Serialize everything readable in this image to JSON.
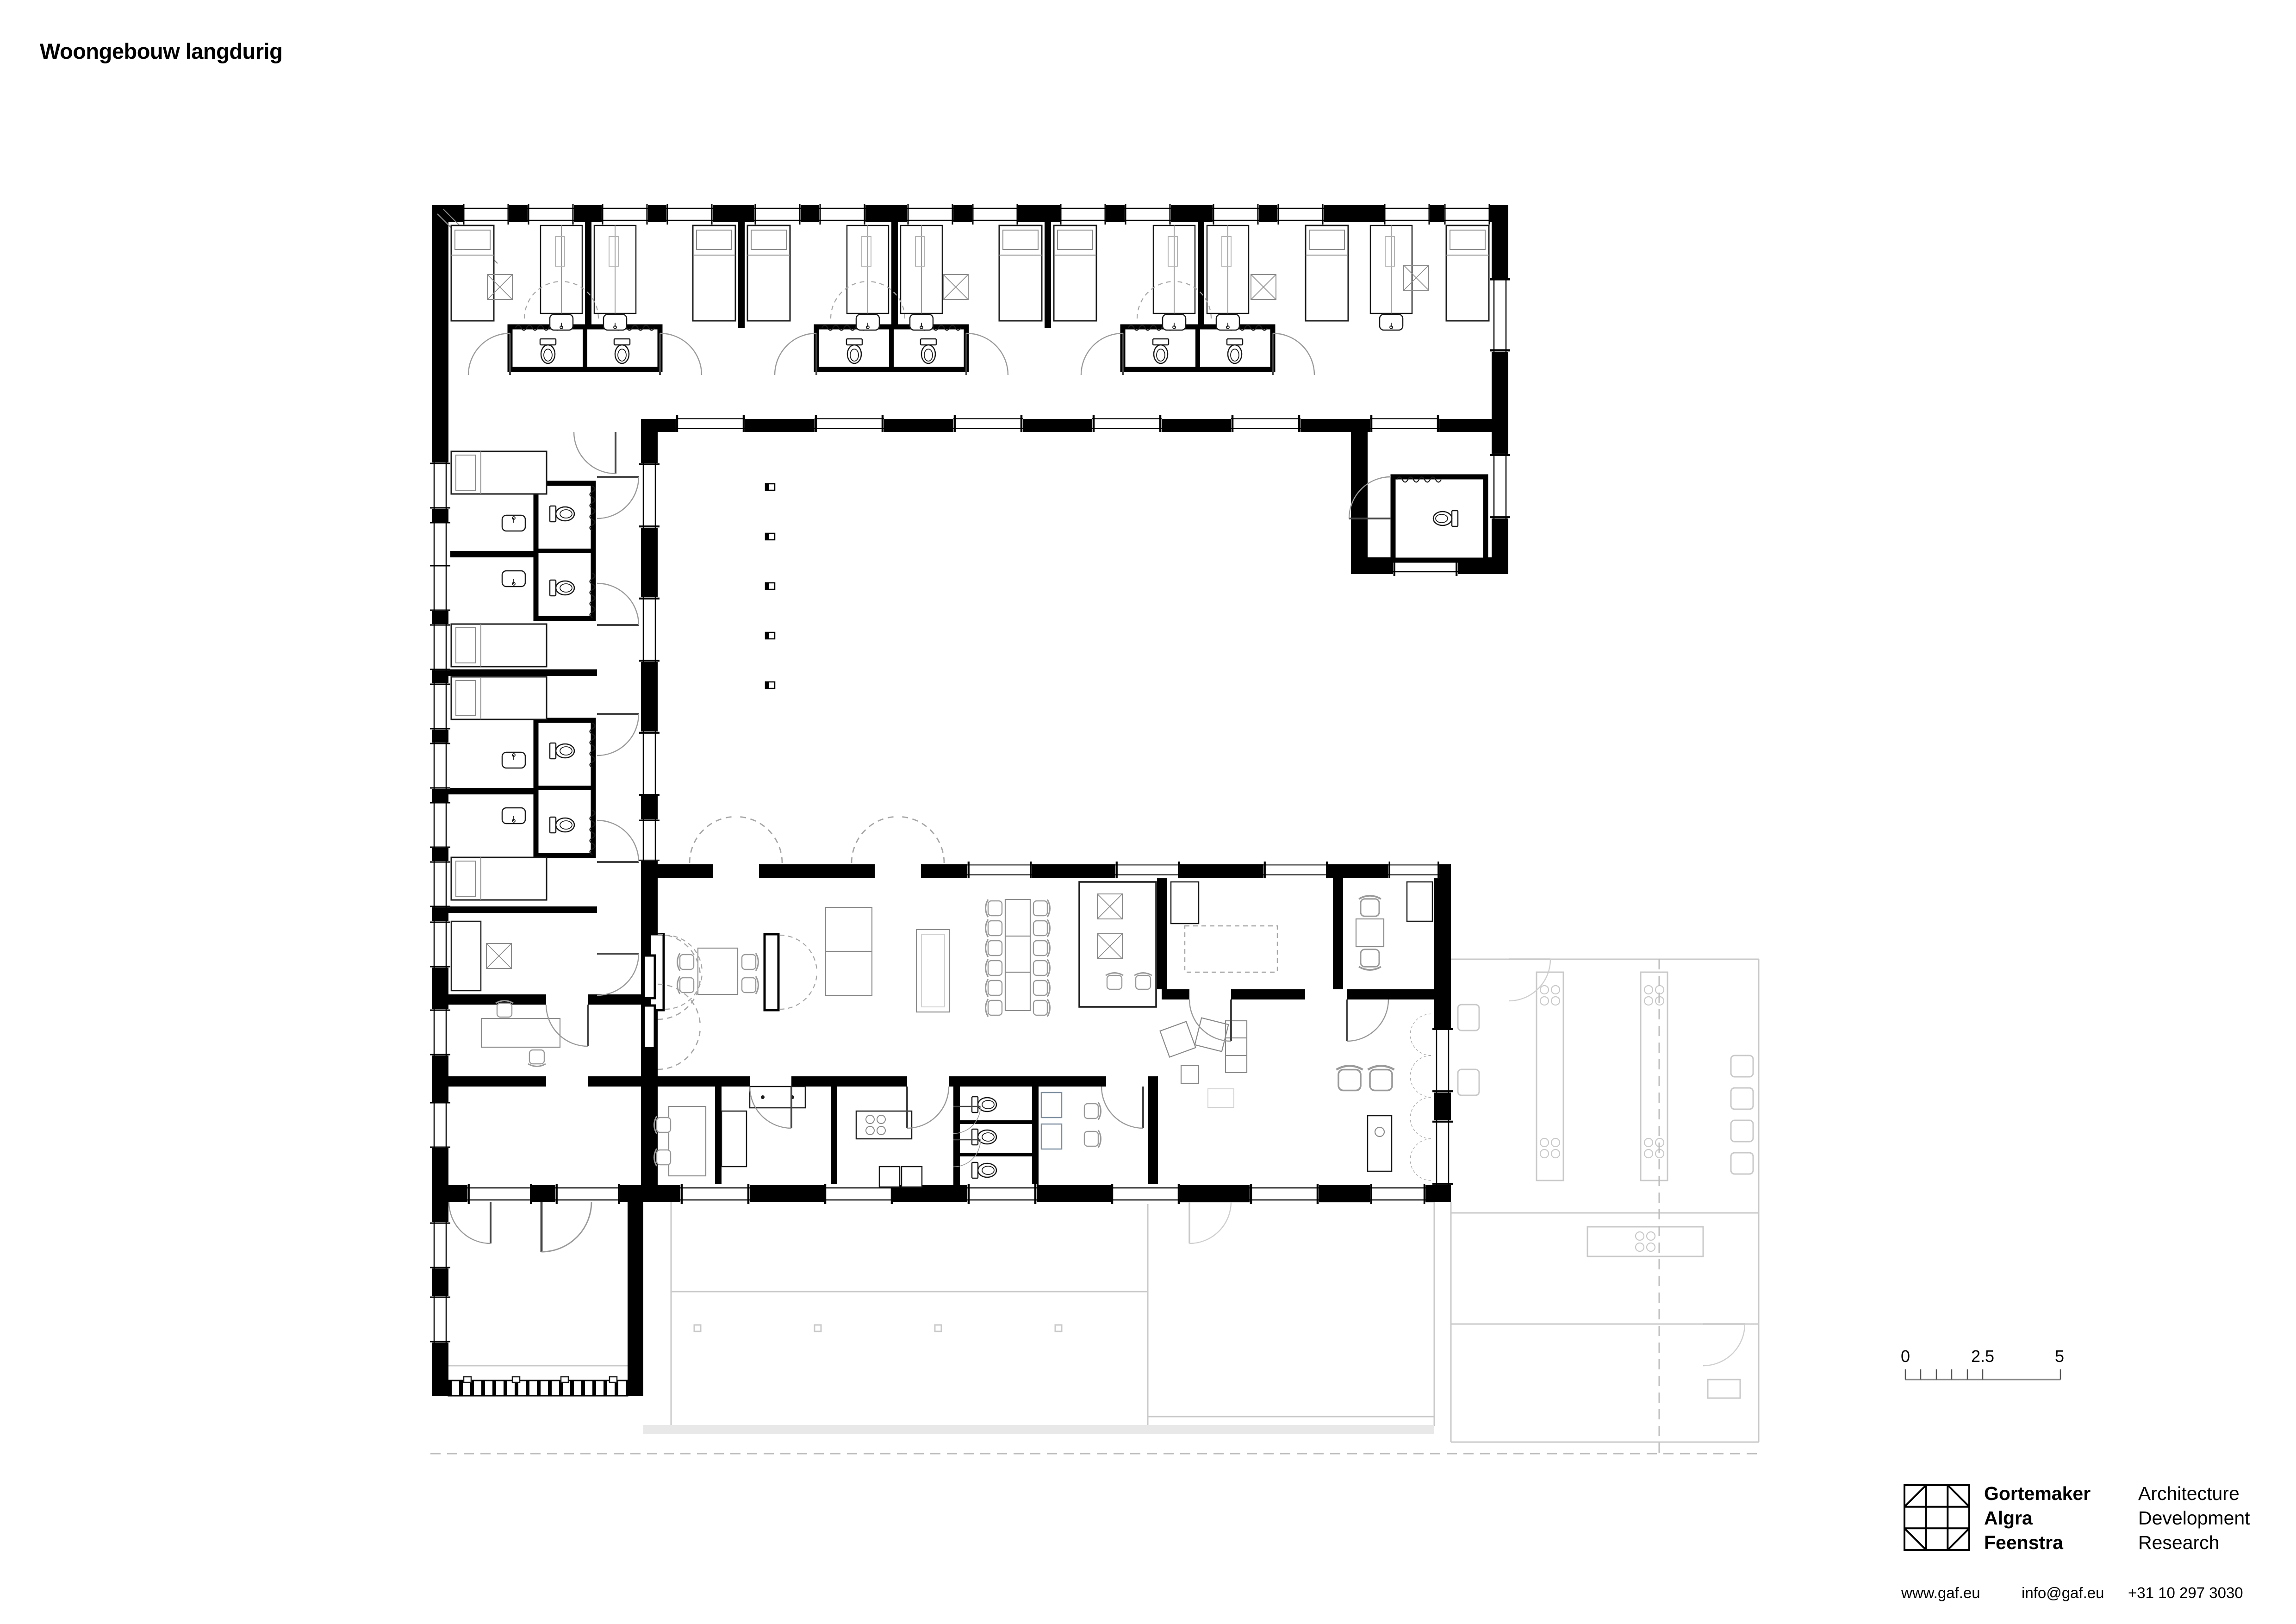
{
  "title": "Woongebouw langdurig",
  "plan": {
    "type": "architectural-floor-plan",
    "colors": {
      "walls": "#000000",
      "fixtures": "#1a1a1a",
      "furniture_line": "#8a8a8a",
      "door_arcs": "#9a9a9a",
      "adjacent_building": "#c9c9c9",
      "background": "#ffffff"
    }
  },
  "scale_bar": {
    "labels": [
      "0",
      "2.5",
      "5"
    ]
  },
  "logo": {
    "glyph": "gaf-grid-logo-icon",
    "name_lines": [
      "Gortemaker",
      "Algra",
      "Feenstra"
    ],
    "discipline_lines": [
      "Architecture",
      "Development",
      "Research"
    ],
    "website": "www.gaf.eu",
    "email": "info@gaf.eu",
    "phone": "+31 10 297 3030"
  }
}
